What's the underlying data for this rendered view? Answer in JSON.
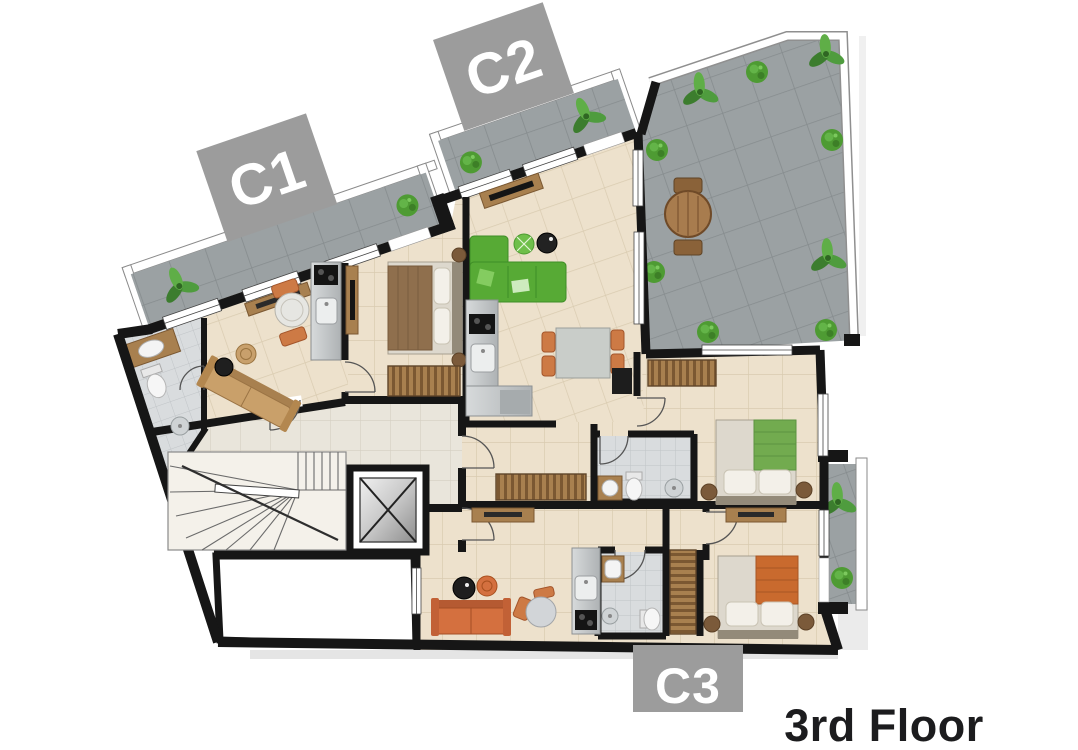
{
  "canvas": {
    "width": 1078,
    "height": 750,
    "background": "#ffffff"
  },
  "floor_plan": {
    "title": "3rd Floor",
    "title_color": "#1c1c1e",
    "units": [
      {
        "id": "c1",
        "label": "C1"
      },
      {
        "id": "c2",
        "label": "C2"
      },
      {
        "id": "c3",
        "label": "C3"
      }
    ],
    "unit_label_box_color": "#9c9c9c",
    "unit_label_text_color": "#ffffff",
    "rooms": [
      "terrace",
      "balcony",
      "living-dining",
      "kitchen",
      "bedroom",
      "bathroom",
      "hallway",
      "staircase",
      "elevator",
      "lightwell"
    ],
    "palette": {
      "walls": "#161616",
      "unit_floor": "#ede1cc",
      "hall_floor": "#e9e5db",
      "terrace_floor": "#9ba1a3",
      "bathroom_floor": "#d9dcde",
      "sofa_green": "#57aa35",
      "sofa_orange": "#d4703f",
      "sofa_tan": "#c9a06a",
      "wood": "#a8804f",
      "plant_green": "#4e9b33",
      "stainless": "#c2c6c8",
      "bed_linen": "#ddd8cd",
      "blanket_green": "#72ab4f",
      "blanket_orange": "#c96a2e",
      "blanket_brown": "#8f6f4d"
    }
  }
}
